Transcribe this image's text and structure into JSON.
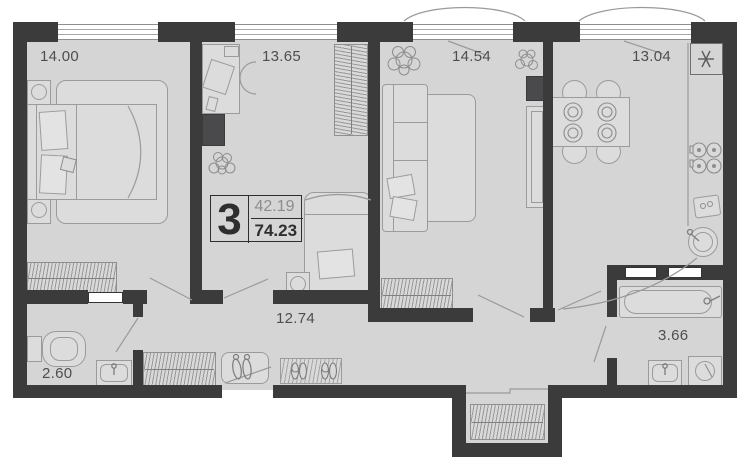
{
  "plan_summary": {
    "rooms_count": "3",
    "living_area": "42.19",
    "total_area": "74.23"
  },
  "rooms": {
    "bedroom1": {
      "area": "14.00"
    },
    "bedroom2": {
      "area": "13.65"
    },
    "living_room": {
      "area": "14.54"
    },
    "kitchen": {
      "area": "13.04"
    },
    "hallway": {
      "area": "12.74"
    },
    "wc": {
      "area": "2.60"
    },
    "bathroom": {
      "area": "3.66"
    }
  },
  "symbols": {
    "vent_shaft": "✳"
  },
  "colors": {
    "wall": "#3b3b3c",
    "floor": "#d5d5d6",
    "furniture_fill": "#dcdcdc",
    "furniture_stroke": "#9b9b9b",
    "label_text": "#4e4e4f",
    "living_area_text": "#8d8d8e",
    "total_area_text": "#2e2e2f",
    "window_fill": "#ffffff"
  }
}
